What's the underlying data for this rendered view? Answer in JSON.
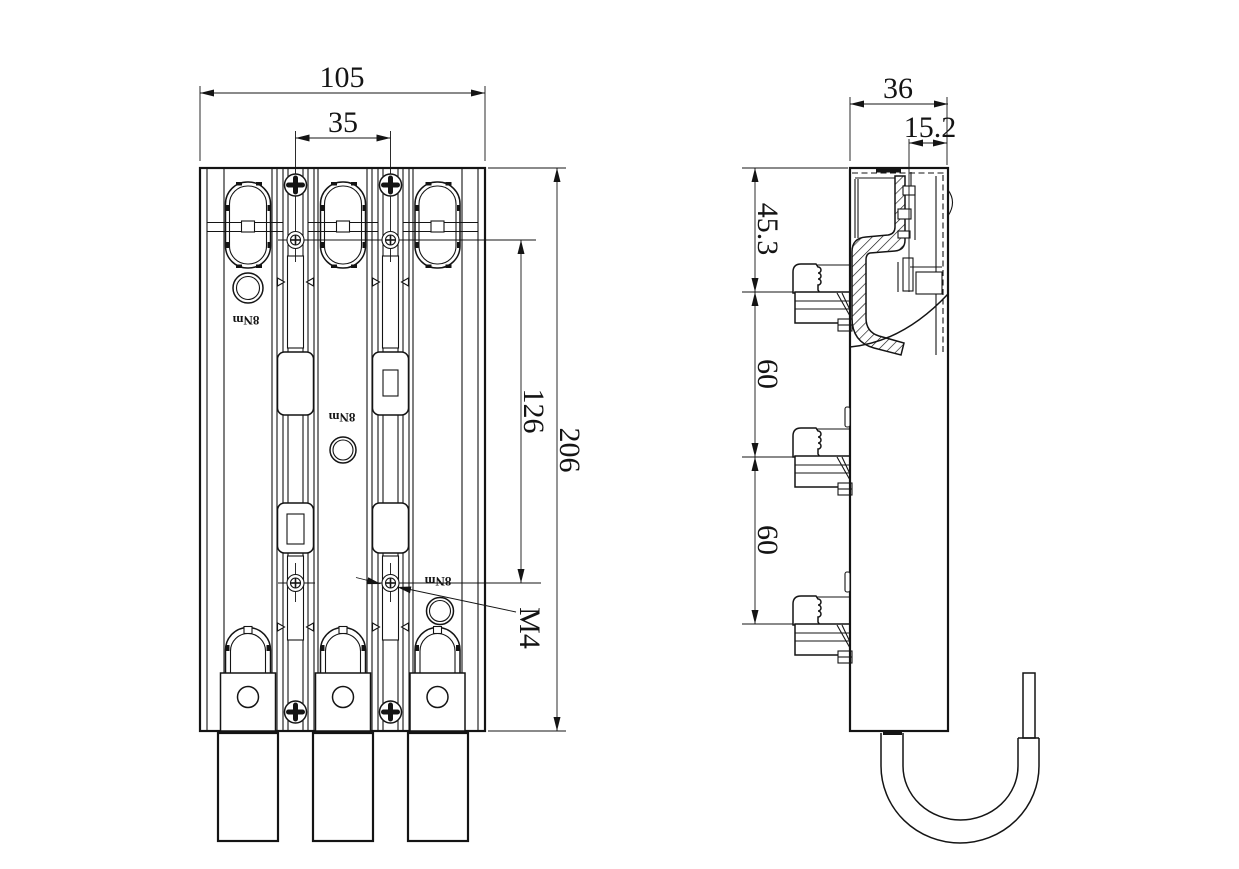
{
  "drawing": {
    "type": "technical-drawing",
    "colors": {
      "line": "#141414",
      "background": "#ffffff"
    },
    "front_view": {
      "overall_width": "105",
      "pole_pitch": "35",
      "overall_height": "206",
      "fixing_screw_span": "126",
      "thread_label": "M4",
      "torque_labels": [
        "8Nm",
        "8Nm",
        "8Nm"
      ]
    },
    "side_view": {
      "overall_depth": "36",
      "rail_offset": "15.2",
      "upper_section_height": "45.3",
      "claw_pitch_upper": "60",
      "claw_pitch_lower": "60"
    }
  }
}
